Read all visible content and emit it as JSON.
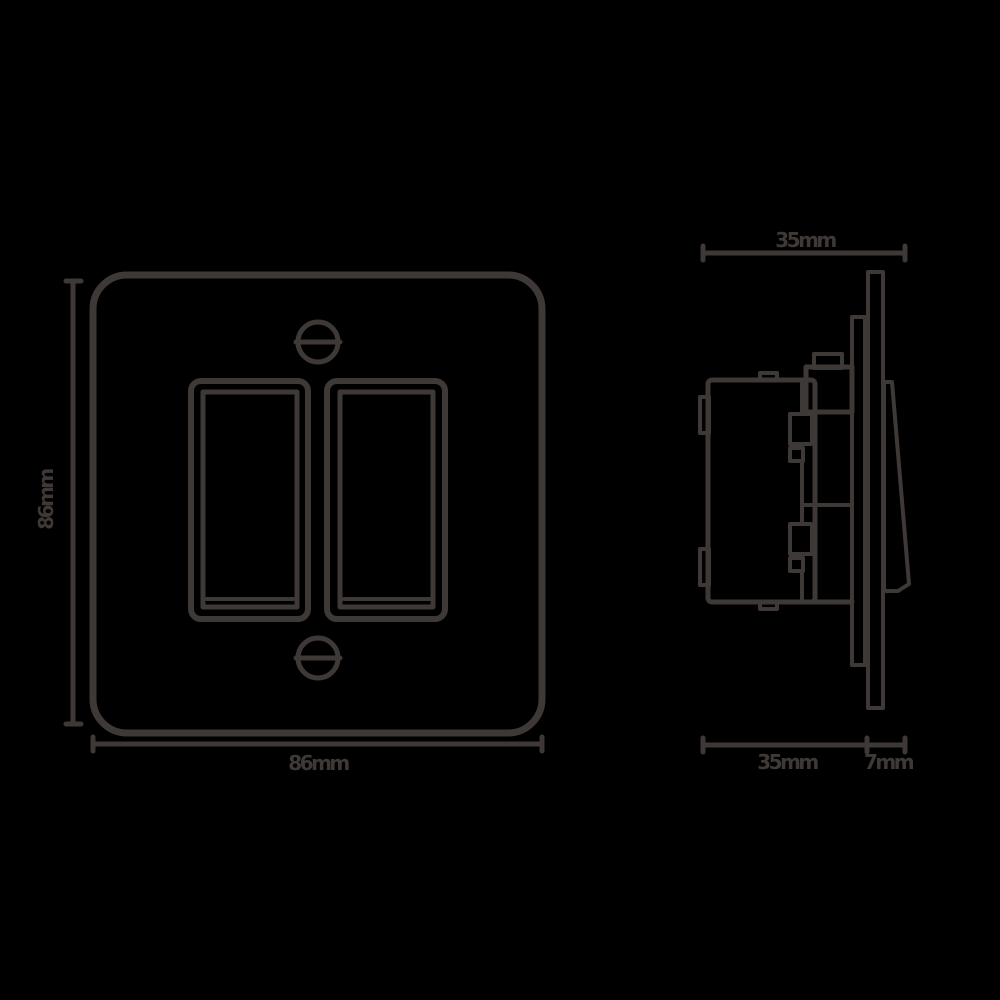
{
  "diagram": {
    "subject": "2-gang rocker light switch dimension drawing",
    "stroke_color": "#3e3936",
    "background_color": "#000000",
    "front_view": {
      "width_label": "86mm",
      "height_label": "86mm"
    },
    "side_view": {
      "overall_depth_label": "35mm",
      "box_depth_label": "35mm",
      "faceplate_depth_label": "7mm"
    }
  }
}
